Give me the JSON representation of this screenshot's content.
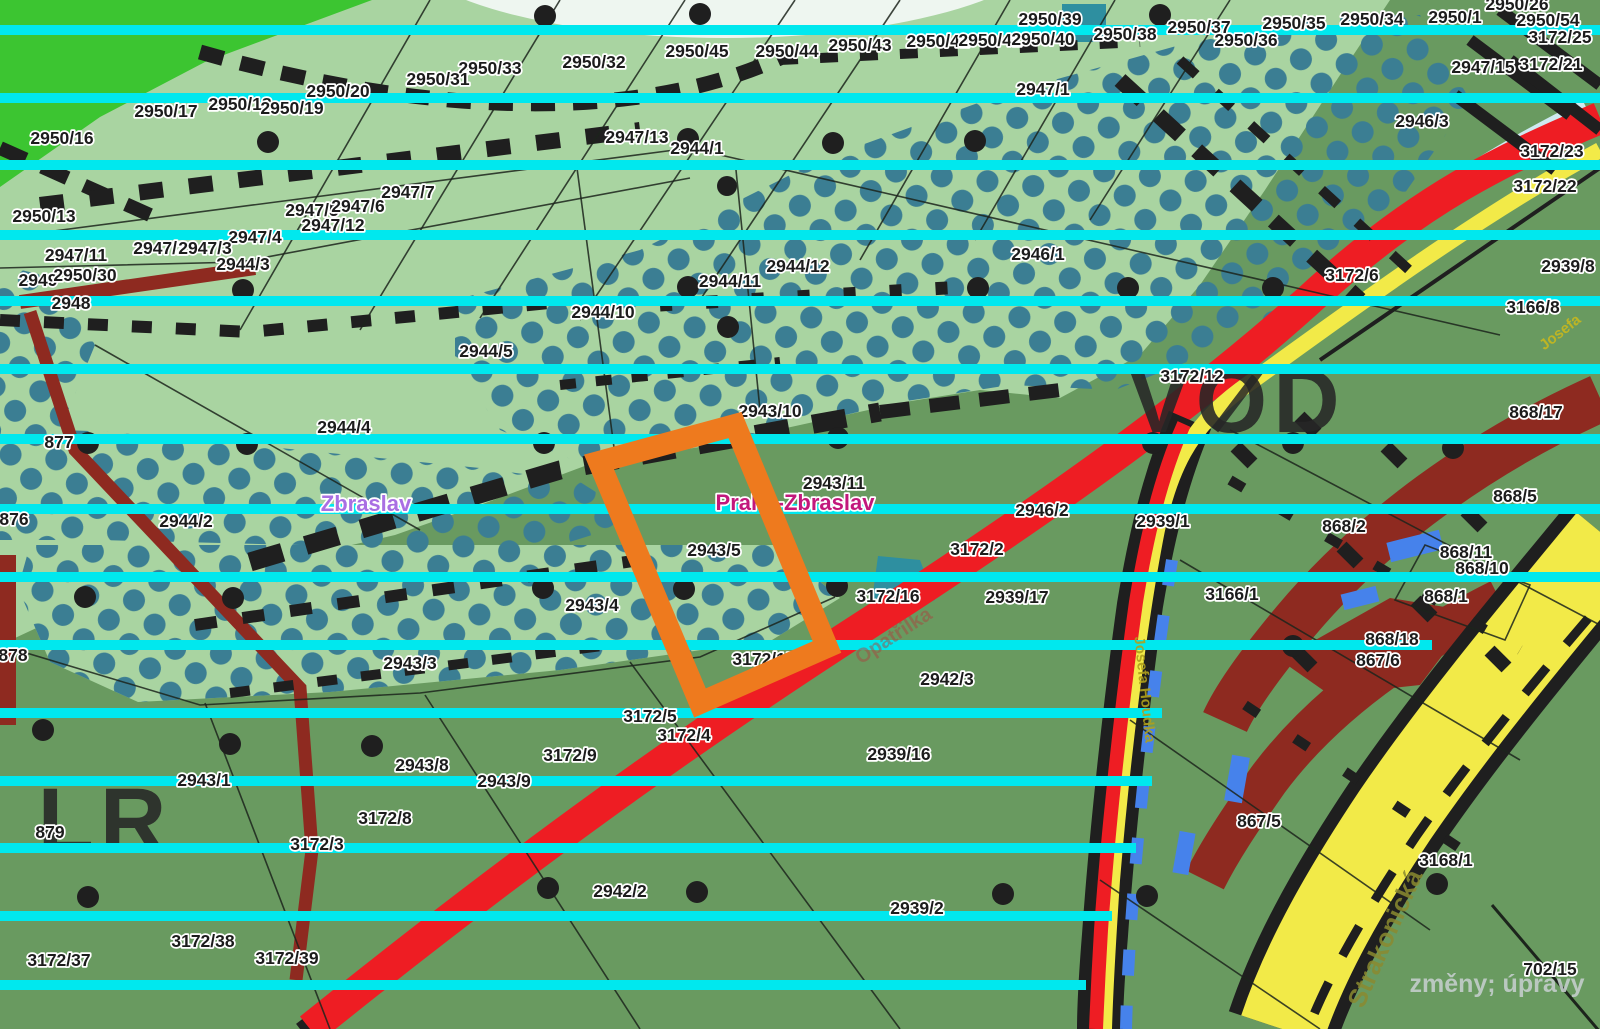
{
  "map": {
    "description": "cadastral zoning map of Praha-Zbraslav",
    "colors": {
      "light_green": "#a9d4a1",
      "dark_green": "#699a60",
      "bright_green": "#3cc531",
      "dot_teal": "#3b7e93",
      "cyan_line": "#00e8ee",
      "road_red": "#ee1d23",
      "road_yellow": "#f2ea48",
      "maroon": "#8e2a20",
      "blue_dash": "#4682eb",
      "pale_stripe": "#cfe9f0",
      "highlight_orange": "#ee7a1e",
      "label_text": "#1c1c1c"
    },
    "highlight": {
      "parcel": "2943/5",
      "color": "#ee7a1e"
    },
    "watermark": {
      "text": "změny; úpravy"
    },
    "place_labels": [
      {
        "text": "Zbraslav",
        "x": 366,
        "y": 511,
        "kind": "city"
      },
      {
        "text": "Praha-Zbraslav",
        "x": 795,
        "y": 510,
        "kind": "district"
      }
    ],
    "big_letters": [
      {
        "text": "VOD",
        "x": 1237,
        "y": 432
      },
      {
        "text": "LR",
        "x": 105,
        "y": 852
      }
    ],
    "street_labels": [
      {
        "text": "Josefa",
        "x": 1563,
        "y": 336,
        "rot": -38,
        "size": 15,
        "color": "#c8b81e",
        "opacity": 0.9
      },
      {
        "text": "Josefa Houdka",
        "x": 1140,
        "y": 690,
        "rot": 84,
        "size": 15,
        "color": "#b0a01c",
        "opacity": 0.9
      },
      {
        "text": "Strakonická",
        "x": 1393,
        "y": 942,
        "rot": -66,
        "size": 26,
        "color": "#8a8a30",
        "opacity": 0.85
      },
      {
        "text": "Opatřilka",
        "x": 897,
        "y": 641,
        "rot": -33,
        "size": 20,
        "color": "#a84840",
        "opacity": 0.5
      }
    ],
    "parcel_labels": [
      {
        "text": "2950/26",
        "x": 1517,
        "y": 10
      },
      {
        "text": "2950/54",
        "x": 1548,
        "y": 26
      },
      {
        "text": "3172/25",
        "x": 1560,
        "y": 43
      },
      {
        "text": "3172/21",
        "x": 1551,
        "y": 70
      },
      {
        "text": "2950/1",
        "x": 1455,
        "y": 23
      },
      {
        "text": "2950/34",
        "x": 1372,
        "y": 25
      },
      {
        "text": "2950/35",
        "x": 1294,
        "y": 29
      },
      {
        "text": "2950/37",
        "x": 1199,
        "y": 33
      },
      {
        "text": "2950/36",
        "x": 1246,
        "y": 46
      },
      {
        "text": "2950/38",
        "x": 1125,
        "y": 40
      },
      {
        "text": "2950/39",
        "x": 1050,
        "y": 25
      },
      {
        "text": "2950/42",
        "x": 938,
        "y": 47
      },
      {
        "text": "2950/41",
        "x": 990,
        "y": 46
      },
      {
        "text": "2950/40",
        "x": 1043,
        "y": 45
      },
      {
        "text": "2950/44",
        "x": 787,
        "y": 57
      },
      {
        "text": "2950/43",
        "x": 860,
        "y": 51
      },
      {
        "text": "2950/45",
        "x": 697,
        "y": 57
      },
      {
        "text": "2950/32",
        "x": 594,
        "y": 68
      },
      {
        "text": "2950/33",
        "x": 490,
        "y": 74
      },
      {
        "text": "2950/31",
        "x": 438,
        "y": 85
      },
      {
        "text": "2950/20",
        "x": 338,
        "y": 97
      },
      {
        "text": "2950/17",
        "x": 166,
        "y": 117
      },
      {
        "text": "2950/18",
        "x": 240,
        "y": 110
      },
      {
        "text": "2950/19",
        "x": 292,
        "y": 114
      },
      {
        "text": "2947/15",
        "x": 1483,
        "y": 73
      },
      {
        "text": "2947/1",
        "x": 1043,
        "y": 95
      },
      {
        "text": "2946/3",
        "x": 1422,
        "y": 127
      },
      {
        "text": "3172/23",
        "x": 1552,
        "y": 157
      },
      {
        "text": "3172/22",
        "x": 1545,
        "y": 192
      },
      {
        "text": "2947/13",
        "x": 637,
        "y": 143
      },
      {
        "text": "2944/1",
        "x": 697,
        "y": 154
      },
      {
        "text": "2950/16",
        "x": 62,
        "y": 144
      },
      {
        "text": "2947/7",
        "x": 408,
        "y": 198
      },
      {
        "text": "2947/5",
        "x": 312,
        "y": 216
      },
      {
        "text": "2947/6",
        "x": 358,
        "y": 212
      },
      {
        "text": "2947/12",
        "x": 333,
        "y": 231
      },
      {
        "text": "2950/13",
        "x": 44,
        "y": 222
      },
      {
        "text": "2947/4",
        "x": 255,
        "y": 243
      },
      {
        "text": "2947/11",
        "x": 76,
        "y": 261
      },
      {
        "text": "2947/2",
        "x": 160,
        "y": 254
      },
      {
        "text": "2947/3",
        "x": 205,
        "y": 254
      },
      {
        "text": "2944/3",
        "x": 243,
        "y": 270
      },
      {
        "text": "2949",
        "x": 38,
        "y": 286
      },
      {
        "text": "2950/30",
        "x": 85,
        "y": 281
      },
      {
        "text": "2948",
        "x": 71,
        "y": 309
      },
      {
        "text": "2944/12",
        "x": 798,
        "y": 272
      },
      {
        "text": "2944/11",
        "x": 730,
        "y": 287
      },
      {
        "text": "2946/1",
        "x": 1038,
        "y": 260
      },
      {
        "text": "3172/6",
        "x": 1352,
        "y": 281
      },
      {
        "text": "2939/8",
        "x": 1568,
        "y": 272
      },
      {
        "text": "3166/8",
        "x": 1533,
        "y": 313
      },
      {
        "text": "2944/10",
        "x": 603,
        "y": 318
      },
      {
        "text": "2944/5",
        "x": 486,
        "y": 357
      },
      {
        "text": "3172/12",
        "x": 1192,
        "y": 382
      },
      {
        "text": "868/17",
        "x": 1536,
        "y": 418
      },
      {
        "text": "2944/4",
        "x": 344,
        "y": 433
      },
      {
        "text": "877",
        "x": 59,
        "y": 448
      },
      {
        "text": "2943/10",
        "x": 770,
        "y": 417
      },
      {
        "text": "2943/11",
        "x": 834,
        "y": 489
      },
      {
        "text": "2946/2",
        "x": 1042,
        "y": 516
      },
      {
        "text": "2939/1",
        "x": 1163,
        "y": 527
      },
      {
        "text": "868/2",
        "x": 1344,
        "y": 532
      },
      {
        "text": "868/5",
        "x": 1515,
        "y": 502
      },
      {
        "text": "3172/2",
        "x": 977,
        "y": 555
      },
      {
        "text": "2943/5",
        "x": 714,
        "y": 556
      },
      {
        "text": "868/11",
        "x": 1466,
        "y": 558
      },
      {
        "text": "868/10",
        "x": 1482,
        "y": 574
      },
      {
        "text": "868/1",
        "x": 1446,
        "y": 602
      },
      {
        "text": "876",
        "x": 14,
        "y": 525
      },
      {
        "text": "2944/2",
        "x": 186,
        "y": 527
      },
      {
        "text": "2943/4",
        "x": 592,
        "y": 611
      },
      {
        "text": "2939/17",
        "x": 1017,
        "y": 603
      },
      {
        "text": "3172/16",
        "x": 888,
        "y": 602
      },
      {
        "text": "3166/1",
        "x": 1232,
        "y": 600
      },
      {
        "text": "868/18",
        "x": 1392,
        "y": 645
      },
      {
        "text": "867/6",
        "x": 1378,
        "y": 666
      },
      {
        "text": "2943/3",
        "x": 410,
        "y": 669
      },
      {
        "text": "3172/15",
        "x": 764,
        "y": 665
      },
      {
        "text": "2942/3",
        "x": 947,
        "y": 685
      },
      {
        "text": "3172/5",
        "x": 650,
        "y": 722
      },
      {
        "text": "3172/4",
        "x": 684,
        "y": 741
      },
      {
        "text": "3172/9",
        "x": 570,
        "y": 761
      },
      {
        "text": "878",
        "x": 13,
        "y": 661
      },
      {
        "text": "2943/9",
        "x": 504,
        "y": 787
      },
      {
        "text": "2939/16",
        "x": 899,
        "y": 760
      },
      {
        "text": "2943/8",
        "x": 422,
        "y": 771
      },
      {
        "text": "2943/1",
        "x": 204,
        "y": 786
      },
      {
        "text": "3172/8",
        "x": 385,
        "y": 824
      },
      {
        "text": "879",
        "x": 50,
        "y": 838
      },
      {
        "text": "3172/3",
        "x": 317,
        "y": 850
      },
      {
        "text": "2942/2",
        "x": 620,
        "y": 897
      },
      {
        "text": "3168/1",
        "x": 1446,
        "y": 866
      },
      {
        "text": "2939/2",
        "x": 917,
        "y": 914
      },
      {
        "text": "867/5",
        "x": 1259,
        "y": 827
      },
      {
        "text": "3172/38",
        "x": 203,
        "y": 947
      },
      {
        "text": "3172/39",
        "x": 287,
        "y": 964
      },
      {
        "text": "3172/37",
        "x": 59,
        "y": 966
      },
      {
        "text": "702/15",
        "x": 1550,
        "y": 975
      }
    ]
  }
}
